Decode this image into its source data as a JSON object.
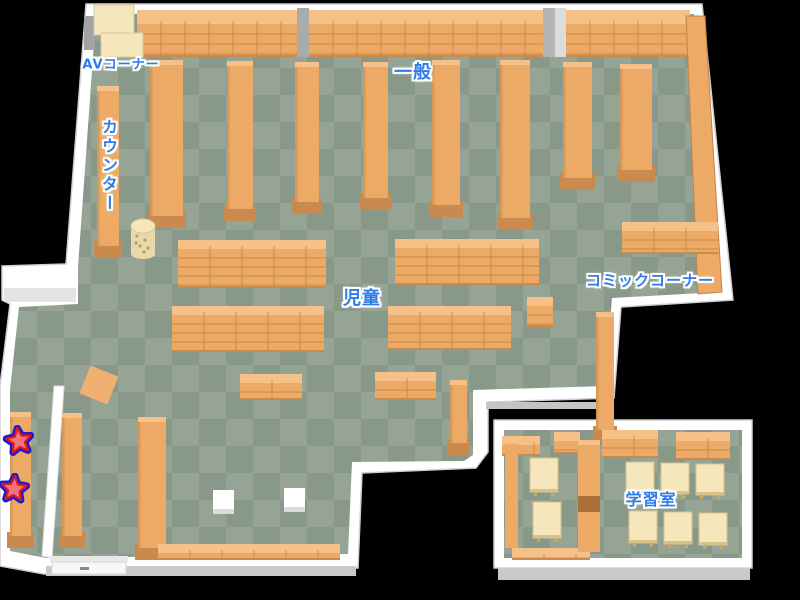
{
  "canvas": {
    "width": 800,
    "height": 600,
    "background": "#000000"
  },
  "colors": {
    "floor_light": "#96a496",
    "floor_dark": "#899989",
    "wall_white": "#ffffff",
    "wall_shadow": "#c9c9c9",
    "wall_gray": "#ababab",
    "shelf": "#ecaa66",
    "shelf_top": "#f6c188",
    "shelf_line": "#c08447",
    "shelf_base": "#c98a4e",
    "cream": "#f5e6bb",
    "cream_dark": "#e9d8a8",
    "label_blue": "#2d7ce8",
    "label_outline": "#ffffff",
    "star_fill": "#f4737f",
    "star_stroke": "#e01818",
    "star_outer": "#1a1ad0",
    "divider_gap": "#aa7038",
    "pillar_white": "#ffffff"
  },
  "labels": [
    {
      "name": "av-corner",
      "text": "AVコーナー",
      "x": 121,
      "y": 63,
      "size": 13,
      "orientation": "horizontal"
    },
    {
      "name": "general",
      "text": "一般",
      "x": 413,
      "y": 71,
      "size": 18,
      "orientation": "horizontal"
    },
    {
      "name": "counter",
      "text": "カウンター",
      "x": 108,
      "y": 166,
      "size": 16,
      "orientation": "vertical"
    },
    {
      "name": "children",
      "text": "児童",
      "x": 362,
      "y": 297,
      "size": 18,
      "orientation": "horizontal"
    },
    {
      "name": "comic-corner",
      "text": "コミックコーナー",
      "x": 650,
      "y": 280,
      "size": 15,
      "orientation": "horizontal"
    },
    {
      "name": "study-room",
      "text": "学習室",
      "x": 651,
      "y": 498,
      "size": 16,
      "orientation": "horizontal"
    }
  ],
  "markers": [
    {
      "name": "star-1",
      "icon": "star-icon",
      "x": 19,
      "y": 441,
      "rotation": -8
    },
    {
      "name": "star-2",
      "icon": "star-icon",
      "x": 14,
      "y": 489,
      "rotation": 4
    }
  ],
  "furniture": {
    "top_wall_shelves": [
      {
        "x": 137,
        "y": 10,
        "w": 162,
        "h": 47
      },
      {
        "x": 309,
        "y": 10,
        "w": 234,
        "h": 47
      },
      {
        "x": 566,
        "y": 10,
        "w": 124,
        "h": 47
      }
    ],
    "top_pillars": [
      {
        "x": 297,
        "y": 8,
        "w": 12,
        "h": 49,
        "fill": "#ababab"
      },
      {
        "x": 543,
        "y": 8,
        "w": 12,
        "h": 49,
        "fill": "#b5b5b5"
      },
      {
        "x": 555,
        "y": 8,
        "w": 11,
        "h": 49,
        "fill": "#dcdcdc"
      }
    ],
    "av_corner_blocks": [
      {
        "x": 84,
        "y": 16,
        "w": 11,
        "h": 34,
        "fill": "#a3a3a3"
      },
      {
        "x": 94,
        "y": 5,
        "w": 40,
        "h": 30,
        "fill": "cream"
      },
      {
        "x": 101,
        "y": 33,
        "w": 42,
        "h": 24,
        "fill": "cream"
      }
    ],
    "vertical_shelves": [
      {
        "x": 97,
        "y": 86,
        "w": 22,
        "h": 172,
        "name": "counter-shelf"
      },
      {
        "x": 150,
        "y": 60,
        "w": 33,
        "h": 168
      },
      {
        "x": 227,
        "y": 61,
        "w": 26,
        "h": 160
      },
      {
        "x": 295,
        "y": 62,
        "w": 24,
        "h": 152
      },
      {
        "x": 363,
        "y": 62,
        "w": 25,
        "h": 148
      },
      {
        "x": 432,
        "y": 60,
        "w": 28,
        "h": 157
      },
      {
        "x": 500,
        "y": 60,
        "w": 30,
        "h": 170
      },
      {
        "x": 563,
        "y": 62,
        "w": 29,
        "h": 128
      },
      {
        "x": 620,
        "y": 64,
        "w": 32,
        "h": 118
      },
      {
        "x": 596,
        "y": 312,
        "w": 18,
        "h": 130,
        "name": "comic-wall-shelf"
      },
      {
        "x": 10,
        "y": 412,
        "w": 21,
        "h": 136,
        "name": "corridor-shelf"
      },
      {
        "x": 62,
        "y": 413,
        "w": 20,
        "h": 135
      },
      {
        "x": 138,
        "y": 417,
        "w": 28,
        "h": 143
      },
      {
        "x": 450,
        "y": 380,
        "w": 17,
        "h": 75
      }
    ],
    "low_shelves": [
      {
        "x": 178,
        "y": 240,
        "w": 148,
        "h": 48
      },
      {
        "x": 395,
        "y": 239,
        "w": 144,
        "h": 46
      },
      {
        "x": 172,
        "y": 306,
        "w": 152,
        "h": 46
      },
      {
        "x": 388,
        "y": 306,
        "w": 123,
        "h": 44
      },
      {
        "x": 240,
        "y": 374,
        "w": 62,
        "h": 26
      },
      {
        "x": 375,
        "y": 372,
        "w": 61,
        "h": 28
      },
      {
        "x": 527,
        "y": 297,
        "w": 26,
        "h": 30
      },
      {
        "x": 622,
        "y": 222,
        "w": 96,
        "h": 32,
        "name": "comic-corner-shelf"
      },
      {
        "x": 158,
        "y": 544,
        "w": 182,
        "h": 16
      },
      {
        "x": 602,
        "y": 430,
        "w": 56,
        "h": 28,
        "name": "study-shelf"
      },
      {
        "x": 676,
        "y": 432,
        "w": 54,
        "h": 28,
        "name": "study-shelf"
      },
      {
        "x": 502,
        "y": 436,
        "w": 38,
        "h": 20,
        "name": "study-shelf"
      },
      {
        "x": 554,
        "y": 432,
        "w": 26,
        "h": 22,
        "name": "study-shelf"
      },
      {
        "x": 512,
        "y": 548,
        "w": 78,
        "h": 12,
        "name": "study-shelf"
      }
    ],
    "right_wall_shelf": {
      "points": "686,16 705,16 722,292 698,294"
    },
    "study_divider": {
      "x": 578,
      "y": 440,
      "w": 22,
      "h": 112,
      "gap_y": 496,
      "gap_h": 16
    },
    "study_left_shelf": {
      "x": 505,
      "y": 440,
      "w": 13,
      "h": 108
    },
    "tables": [
      {
        "x": 530,
        "y": 458,
        "w": 28,
        "h": 34
      },
      {
        "x": 533,
        "y": 502,
        "w": 28,
        "h": 36
      },
      {
        "x": 626,
        "y": 462,
        "w": 28,
        "h": 31
      },
      {
        "x": 661,
        "y": 463,
        "w": 28,
        "h": 31
      },
      {
        "x": 696,
        "y": 464,
        "w": 28,
        "h": 31
      },
      {
        "x": 629,
        "y": 511,
        "w": 28,
        "h": 32
      },
      {
        "x": 664,
        "y": 512,
        "w": 28,
        "h": 32
      },
      {
        "x": 699,
        "y": 513,
        "w": 28,
        "h": 32
      }
    ],
    "pillars": [
      {
        "x": 213,
        "y": 490,
        "w": 21,
        "h": 24
      },
      {
        "x": 284,
        "y": 488,
        "w": 21,
        "h": 24
      }
    ],
    "tilted_square": {
      "cx": 99,
      "cy": 385,
      "size": 30,
      "rotation": 22
    },
    "basket": {
      "cx": 143,
      "cy": 228,
      "rx": 12,
      "body_h": 28
    }
  }
}
